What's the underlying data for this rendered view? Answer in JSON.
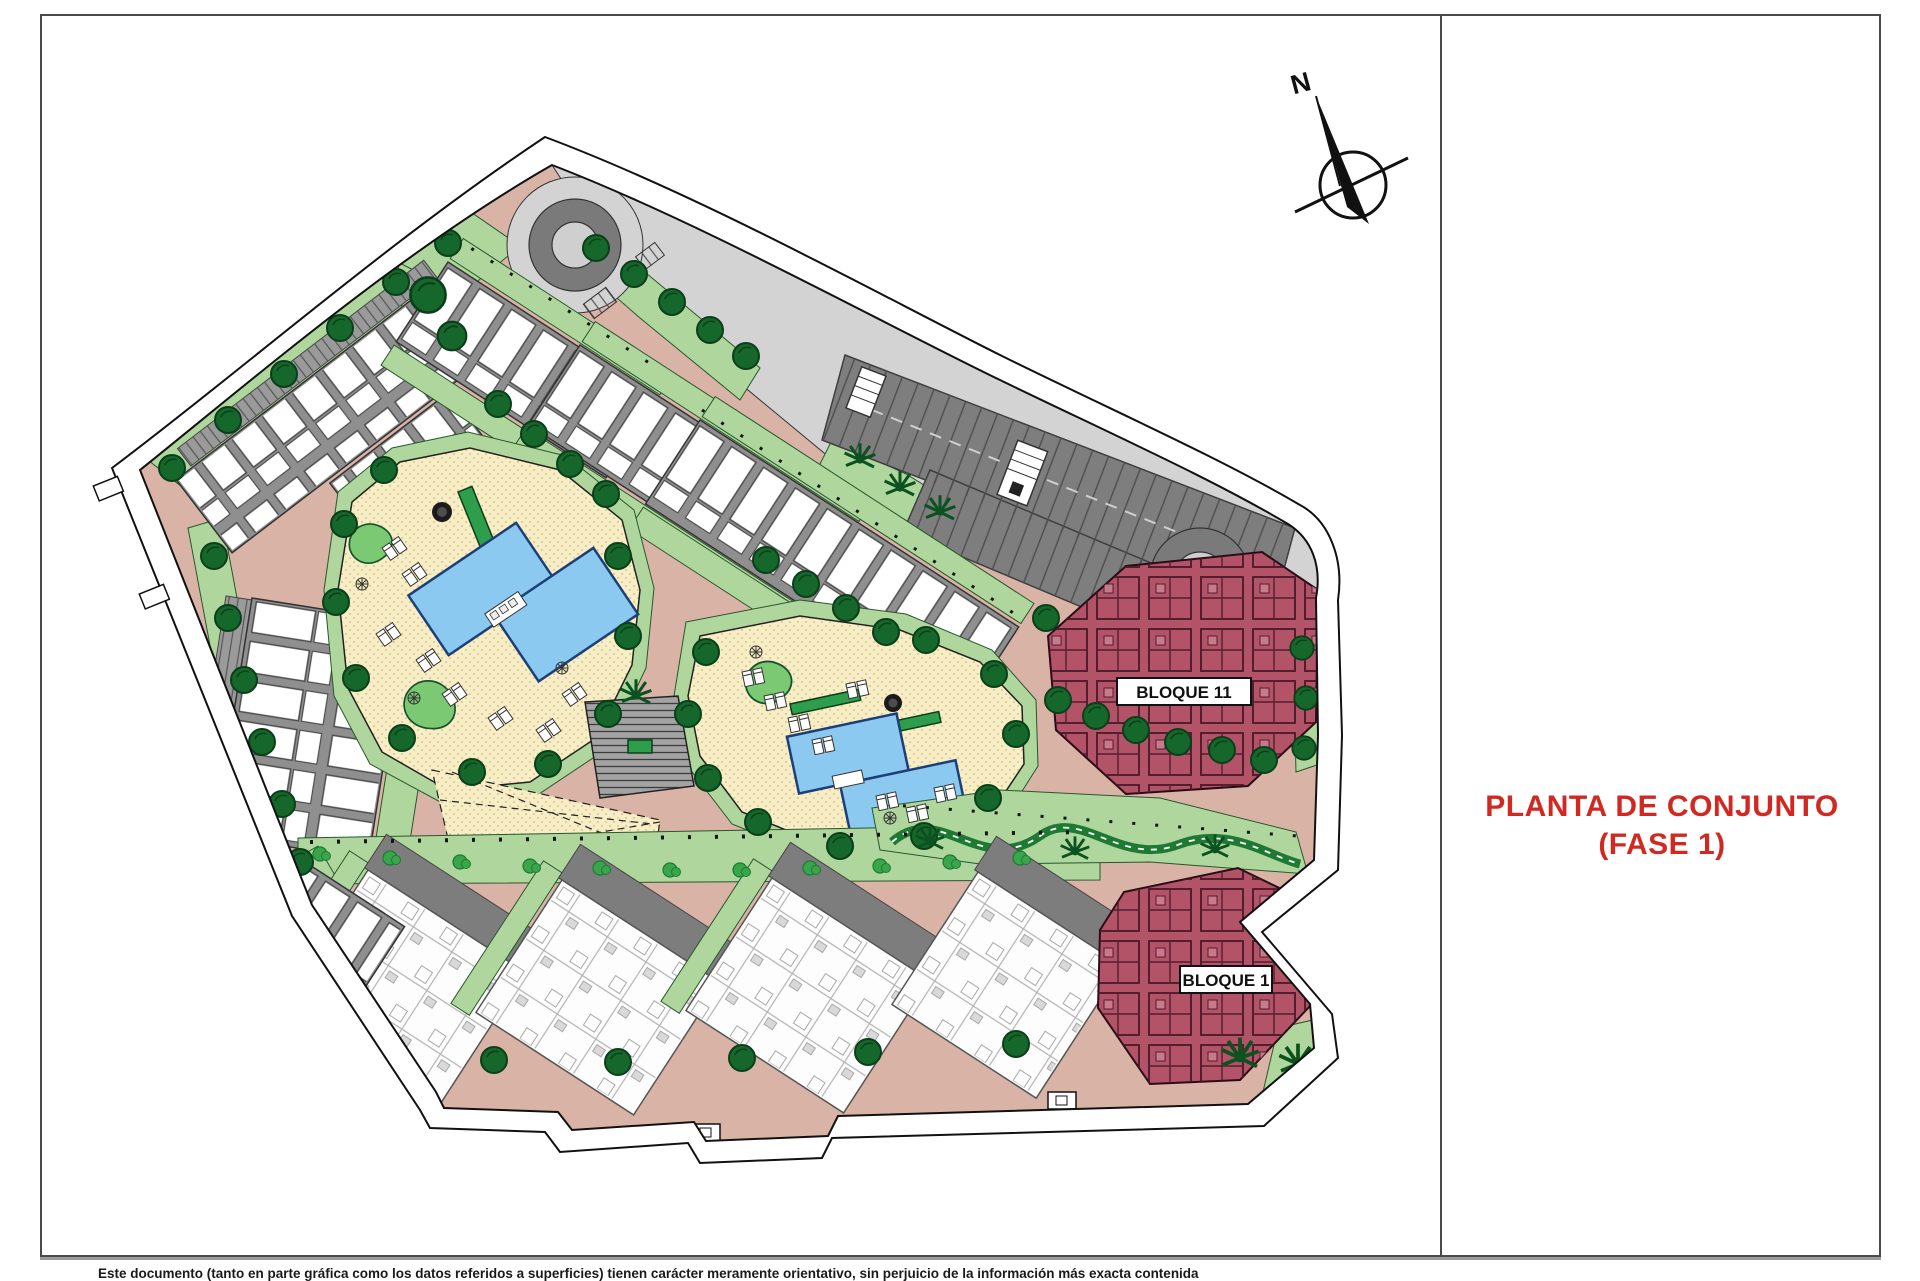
{
  "title_block": {
    "line1": "PLANTA DE CONJUNTO",
    "line2": "(FASE 1)"
  },
  "compass": {
    "north_label": "N"
  },
  "plan": {
    "block_labels": [
      {
        "id": "bloque-11",
        "text": "BLOQUE 11"
      },
      {
        "id": "bloque-1",
        "text": "BLOQUE 1"
      }
    ]
  },
  "footer": {
    "disclaimer": "Este documento (tanto en parte gráfica como los datos referidos a superficies) tienen carácter meramente orientativo, sin perjuicio de la información más exacta contenida"
  },
  "palette": {
    "road": "#d9b3a5",
    "green": "#afd79d",
    "bush": "#3aa64c",
    "tree": "#15672b",
    "tree_line": "#0a3f19",
    "gray_building": "#8f8f8f",
    "gray_shadow": "#7d7d7d",
    "asphalt_dark": "#7e7e7e",
    "asphalt_light": "#d3d3d3",
    "ring": "#7a7a7a",
    "cream": "#f7edc6",
    "cream_dot": "#d9c583",
    "pool": "#8cc9f0",
    "pool_line": "#1d3f77",
    "maroon": "#b25368",
    "title_red": "#d22822",
    "ink": "#1a1a1a",
    "footer_line": "#9a9a9a"
  }
}
